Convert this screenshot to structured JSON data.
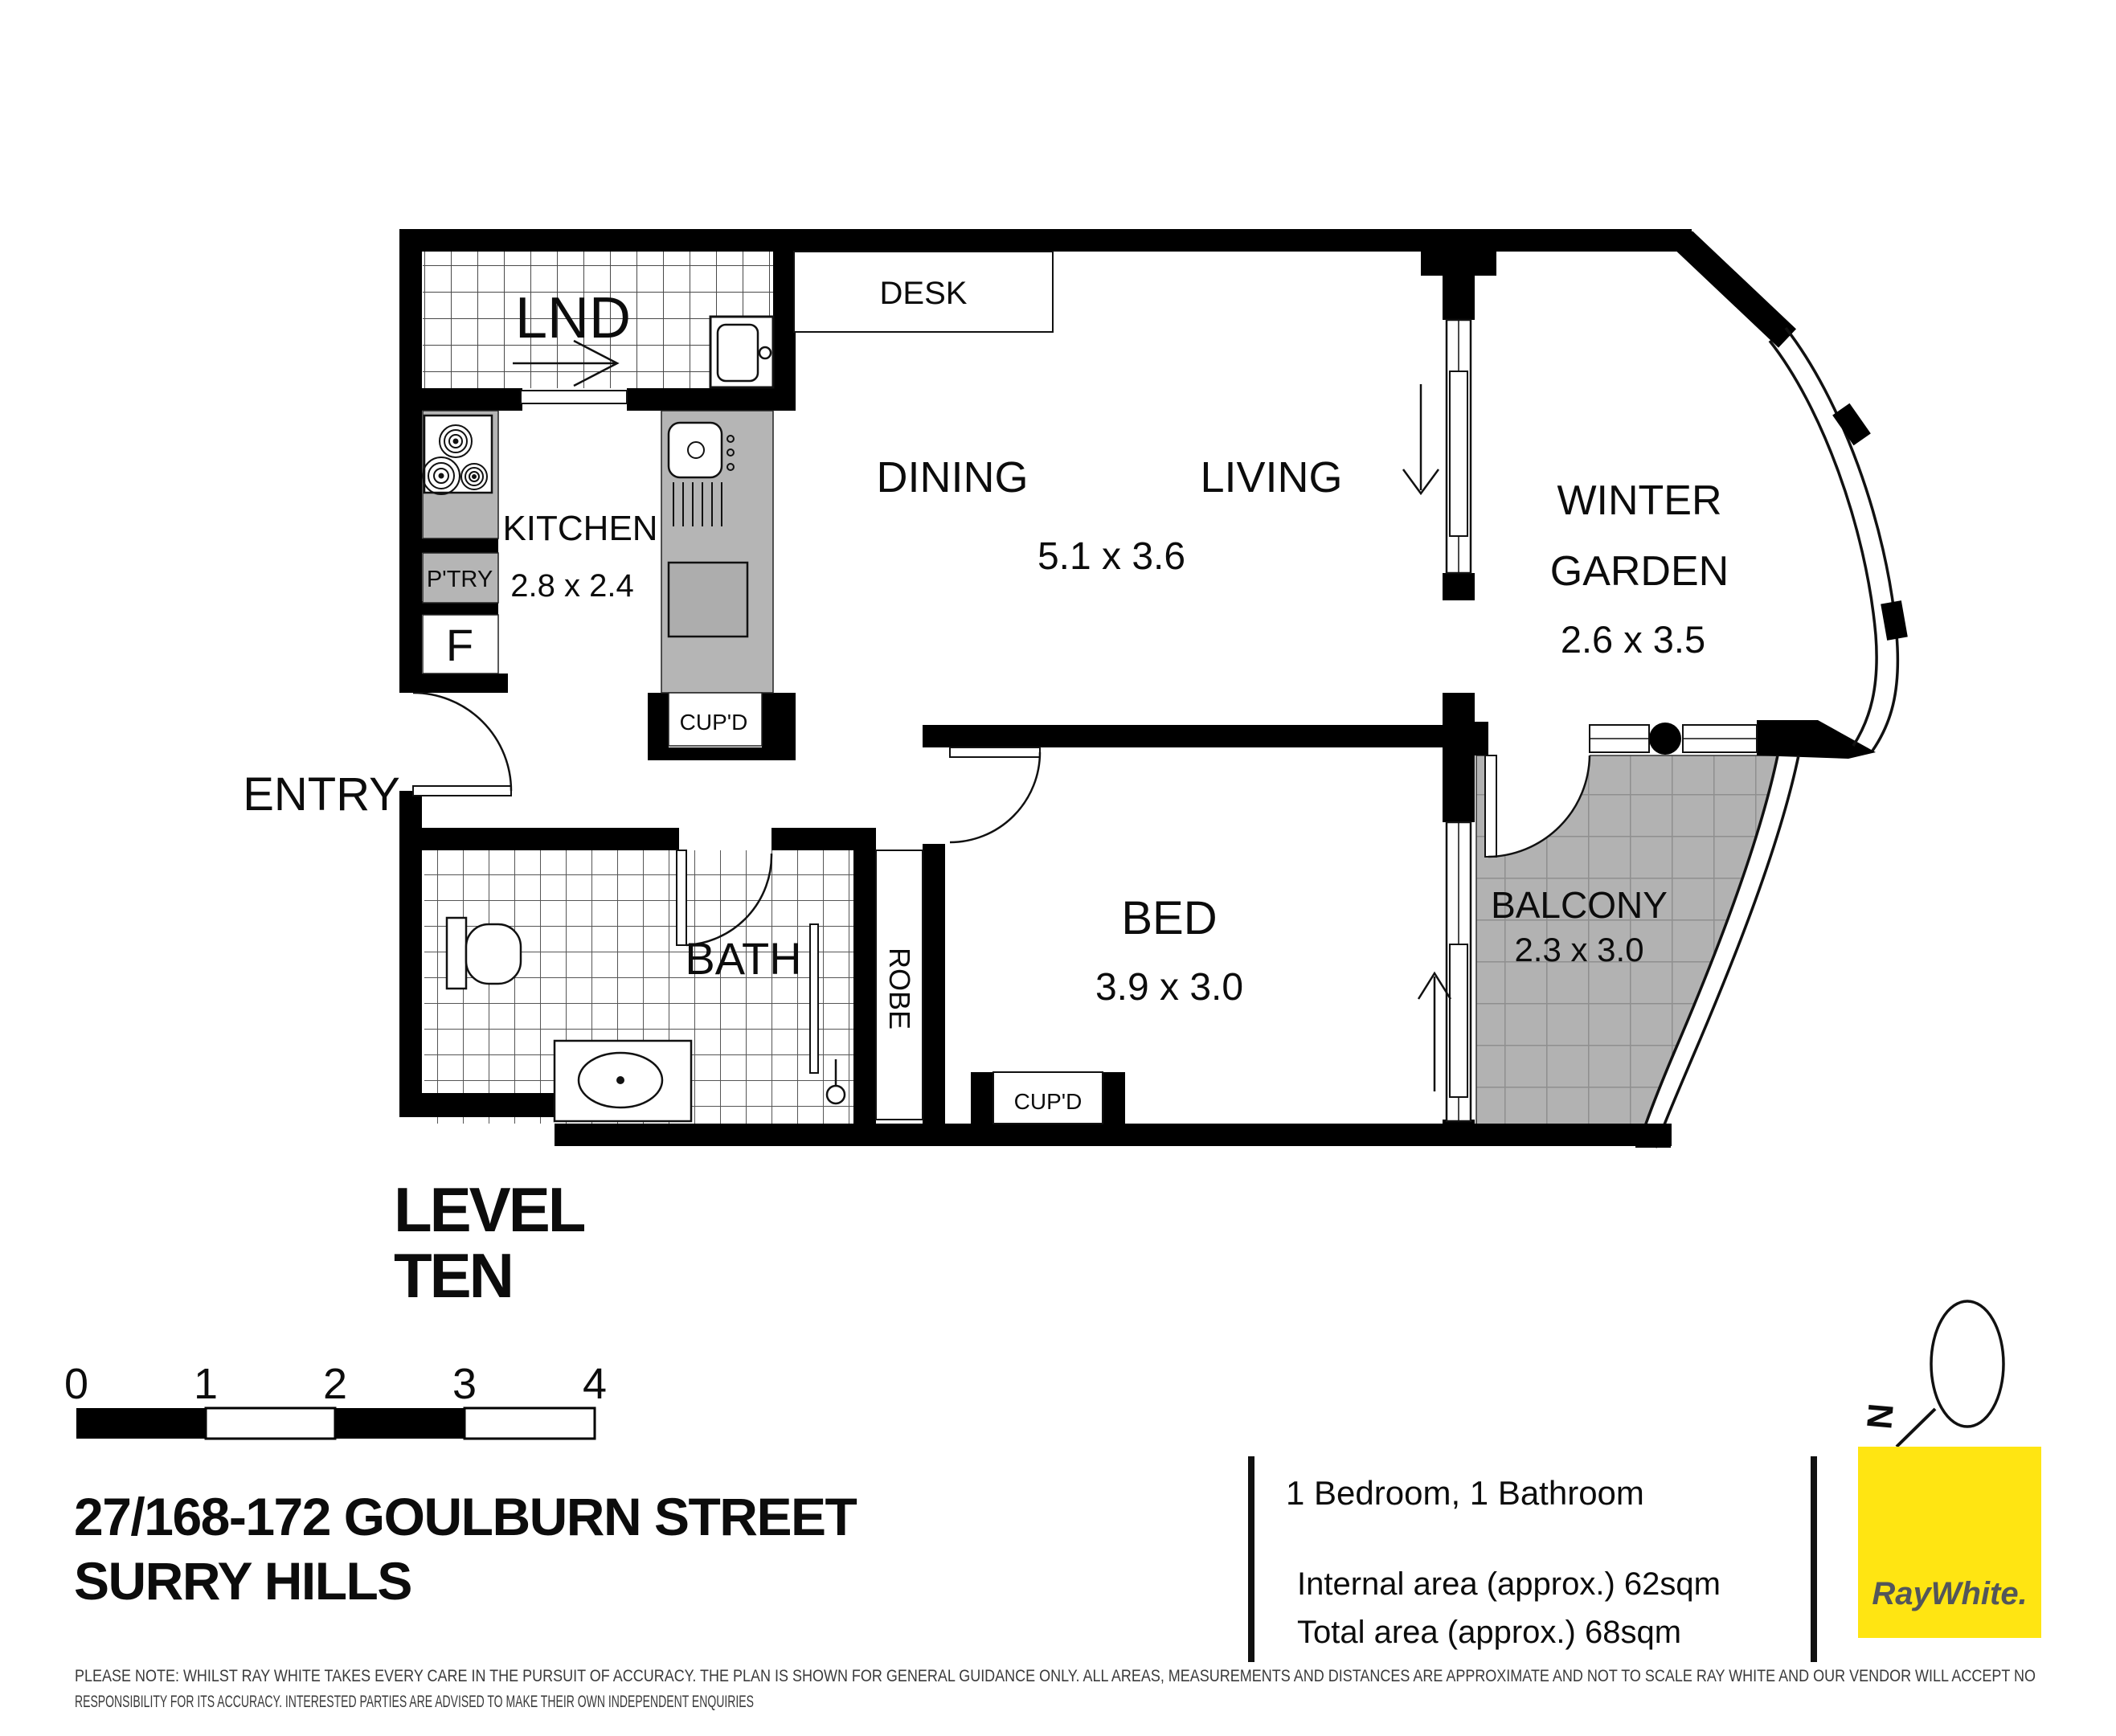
{
  "plan": {
    "rooms": {
      "lnd": {
        "label": "LND"
      },
      "desk": {
        "label": "DESK"
      },
      "kitchen": {
        "label": "KITCHEN",
        "dims": "2.8 x 2.4"
      },
      "pantry": {
        "label": "P'TRY"
      },
      "fridge": {
        "label": "F"
      },
      "kitchen_cupd": {
        "label": "CUP'D"
      },
      "dining": {
        "label": "DINING"
      },
      "living": {
        "label": "LIVING"
      },
      "dining_living_dims": "5.1 x 3.6",
      "winter_garden": {
        "line1": "WINTER",
        "line2": "GARDEN",
        "dims": "2.6 x 3.5"
      },
      "balcony": {
        "label": "BALCONY",
        "dims": "2.3 x 3.0"
      },
      "entry": {
        "label": "ENTRY"
      },
      "bath": {
        "label": "BATH"
      },
      "robe": {
        "label": "ROBE"
      },
      "bed": {
        "label": "BED",
        "dims": "3.9 x 3.0"
      },
      "bed_cupd": {
        "label": "CUP'D"
      }
    },
    "level": {
      "line1": "LEVEL",
      "line2": "TEN"
    }
  },
  "scale_bar": {
    "ticks": [
      "0",
      "1",
      "2",
      "3",
      "4"
    ]
  },
  "address": {
    "line1": "27/168-172 GOULBURN STREET",
    "line2": "SURRY HILLS"
  },
  "summary": {
    "bed_bath": "1 Bedroom, 1 Bathroom",
    "internal_area": "Internal area (approx.) 62sqm",
    "total_area": "Total area (approx.) 68sqm"
  },
  "compass": {
    "label": "N"
  },
  "brand": {
    "name": "RayWhite.",
    "yellow": "#FFE512",
    "text_color": "#53565A"
  },
  "colors": {
    "wall": "#000000",
    "counter_gray": "#b5b5b5",
    "balcony_gray": "#b2b2b2",
    "tile_line": "#8f8f8f"
  },
  "disclaimer": {
    "line1": "PLEASE NOTE: WHILST RAY WHITE TAKES EVERY CARE IN THE PURSUIT OF ACCURACY. THE PLAN IS SHOWN FOR GENERAL GUIDANCE ONLY. ALL AREAS, MEASUREMENTS AND DISTANCES ARE APPROXIMATE AND NOT TO SCALE RAY WHITE AND OUR VENDOR WILL ACCEPT NO",
    "line2": "RESPONSIBILITY FOR ITS ACCURACY. INTERESTED PARTIES ARE ADVISED TO MAKE THEIR OWN INDEPENDENT ENQUIRIES"
  }
}
